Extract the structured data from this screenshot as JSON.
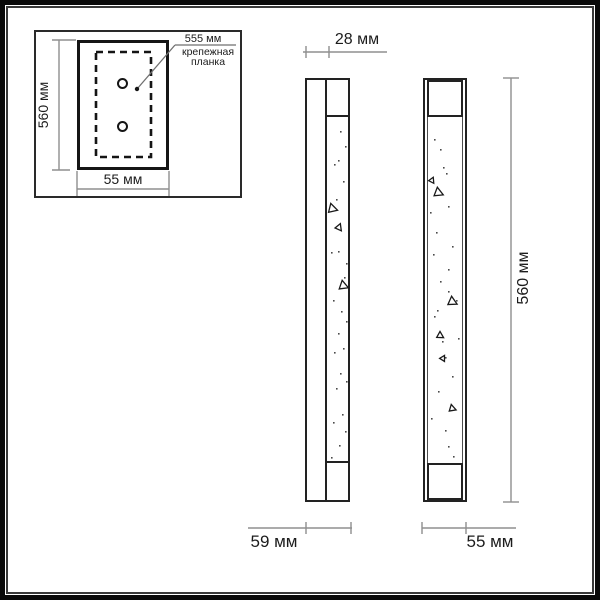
{
  "title": "wall-lamp-dimension-drawing",
  "colors": {
    "line": "#222222",
    "dim_line": "#8f8f8f",
    "leader_line": "#6f6f6f",
    "text": "#1c1c1c",
    "speckle": "#4a4a4a",
    "background": "#ffffff"
  },
  "inset": {
    "height_label": "560 мм",
    "width_label": "55 мм",
    "plate_length_label": "555 мм",
    "plate_caption_line1": "крепежная",
    "plate_caption_line2": "планка"
  },
  "side_view": {
    "top_width_label": "28 мм",
    "bottom_width_label": "59 мм"
  },
  "front_view": {
    "height_label": "560 мм",
    "width_label": "55 мм"
  },
  "decor": {
    "side_view_dots": [
      [
        340,
        131
      ],
      [
        345,
        146
      ],
      [
        338,
        160
      ],
      [
        334,
        164
      ],
      [
        343,
        181
      ],
      [
        336,
        199
      ],
      [
        331,
        252
      ],
      [
        338,
        251
      ],
      [
        346,
        263
      ],
      [
        344,
        277
      ],
      [
        333,
        300
      ],
      [
        341,
        311
      ],
      [
        346,
        321
      ],
      [
        338,
        333
      ],
      [
        343,
        348
      ],
      [
        334,
        352
      ],
      [
        340,
        373
      ],
      [
        346,
        381
      ],
      [
        336,
        388
      ],
      [
        342,
        414
      ],
      [
        333,
        422
      ],
      [
        345,
        431
      ],
      [
        339,
        445
      ],
      [
        331,
        457
      ]
    ],
    "side_view_triangles": [
      [
        332,
        208,
        8,
        -15
      ],
      [
        339,
        227,
        6,
        22
      ],
      [
        343,
        285,
        8,
        -10
      ]
    ],
    "front_view_dots": [
      [
        434,
        139
      ],
      [
        440,
        149
      ],
      [
        443,
        167
      ],
      [
        446,
        173
      ],
      [
        448,
        206
      ],
      [
        430,
        212
      ],
      [
        436,
        232
      ],
      [
        452,
        246
      ],
      [
        433,
        254
      ],
      [
        448,
        269
      ],
      [
        440,
        281
      ],
      [
        448,
        291
      ],
      [
        456,
        300
      ],
      [
        437,
        310
      ],
      [
        434,
        316
      ],
      [
        442,
        341
      ],
      [
        458,
        338
      ],
      [
        445,
        357
      ],
      [
        452,
        376
      ],
      [
        438,
        391
      ],
      [
        431,
        418
      ],
      [
        445,
        430
      ],
      [
        448,
        446
      ],
      [
        453,
        456
      ]
    ],
    "front_view_triangles": [
      [
        432,
        180,
        5,
        25
      ],
      [
        438,
        192,
        8,
        -8
      ],
      [
        452,
        301,
        8,
        -5
      ],
      [
        440,
        335,
        6,
        0
      ],
      [
        443,
        358,
        5,
        30
      ],
      [
        452,
        408,
        6,
        -12
      ]
    ]
  }
}
